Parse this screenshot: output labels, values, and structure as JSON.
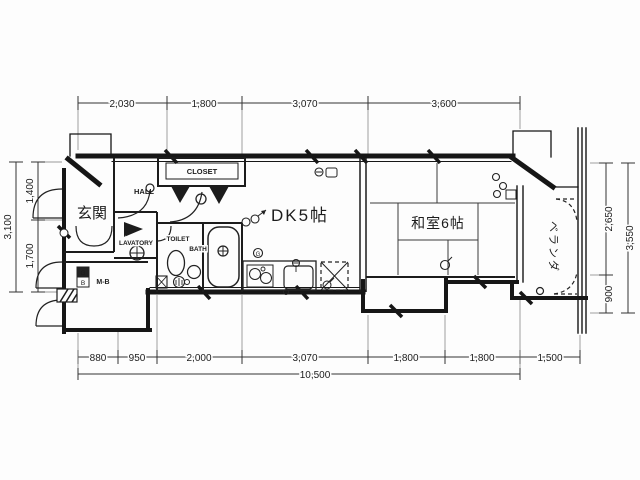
{
  "plan": {
    "type": "floor-plan",
    "rooms": {
      "genkan": "玄関",
      "hall": "HALL",
      "closet": "CLOSET",
      "lavatory": "LAVATORY",
      "toilet": "TOILET",
      "bath": "BATH",
      "meter_box": "M-B",
      "dk": "DK5帖",
      "washitsu": "和室6帖",
      "veranda": "ベランダ",
      "gas_label": "G",
      "breaker_label": "B"
    },
    "dims": {
      "top": [
        "2,030",
        "1,800",
        "3,070",
        "3,600"
      ],
      "bottom": [
        "880",
        "950",
        "2,000",
        "3,070",
        "1,800",
        "1,800",
        "1,500"
      ],
      "bottom_total": "10,500",
      "left": [
        "1,400",
        "1,700"
      ],
      "left_total": "3,100",
      "right": [
        "2,650",
        "900"
      ],
      "right_total": "3,550"
    },
    "colors": {
      "line": "#1c1c1c",
      "paper": "#fdfdfd"
    }
  }
}
